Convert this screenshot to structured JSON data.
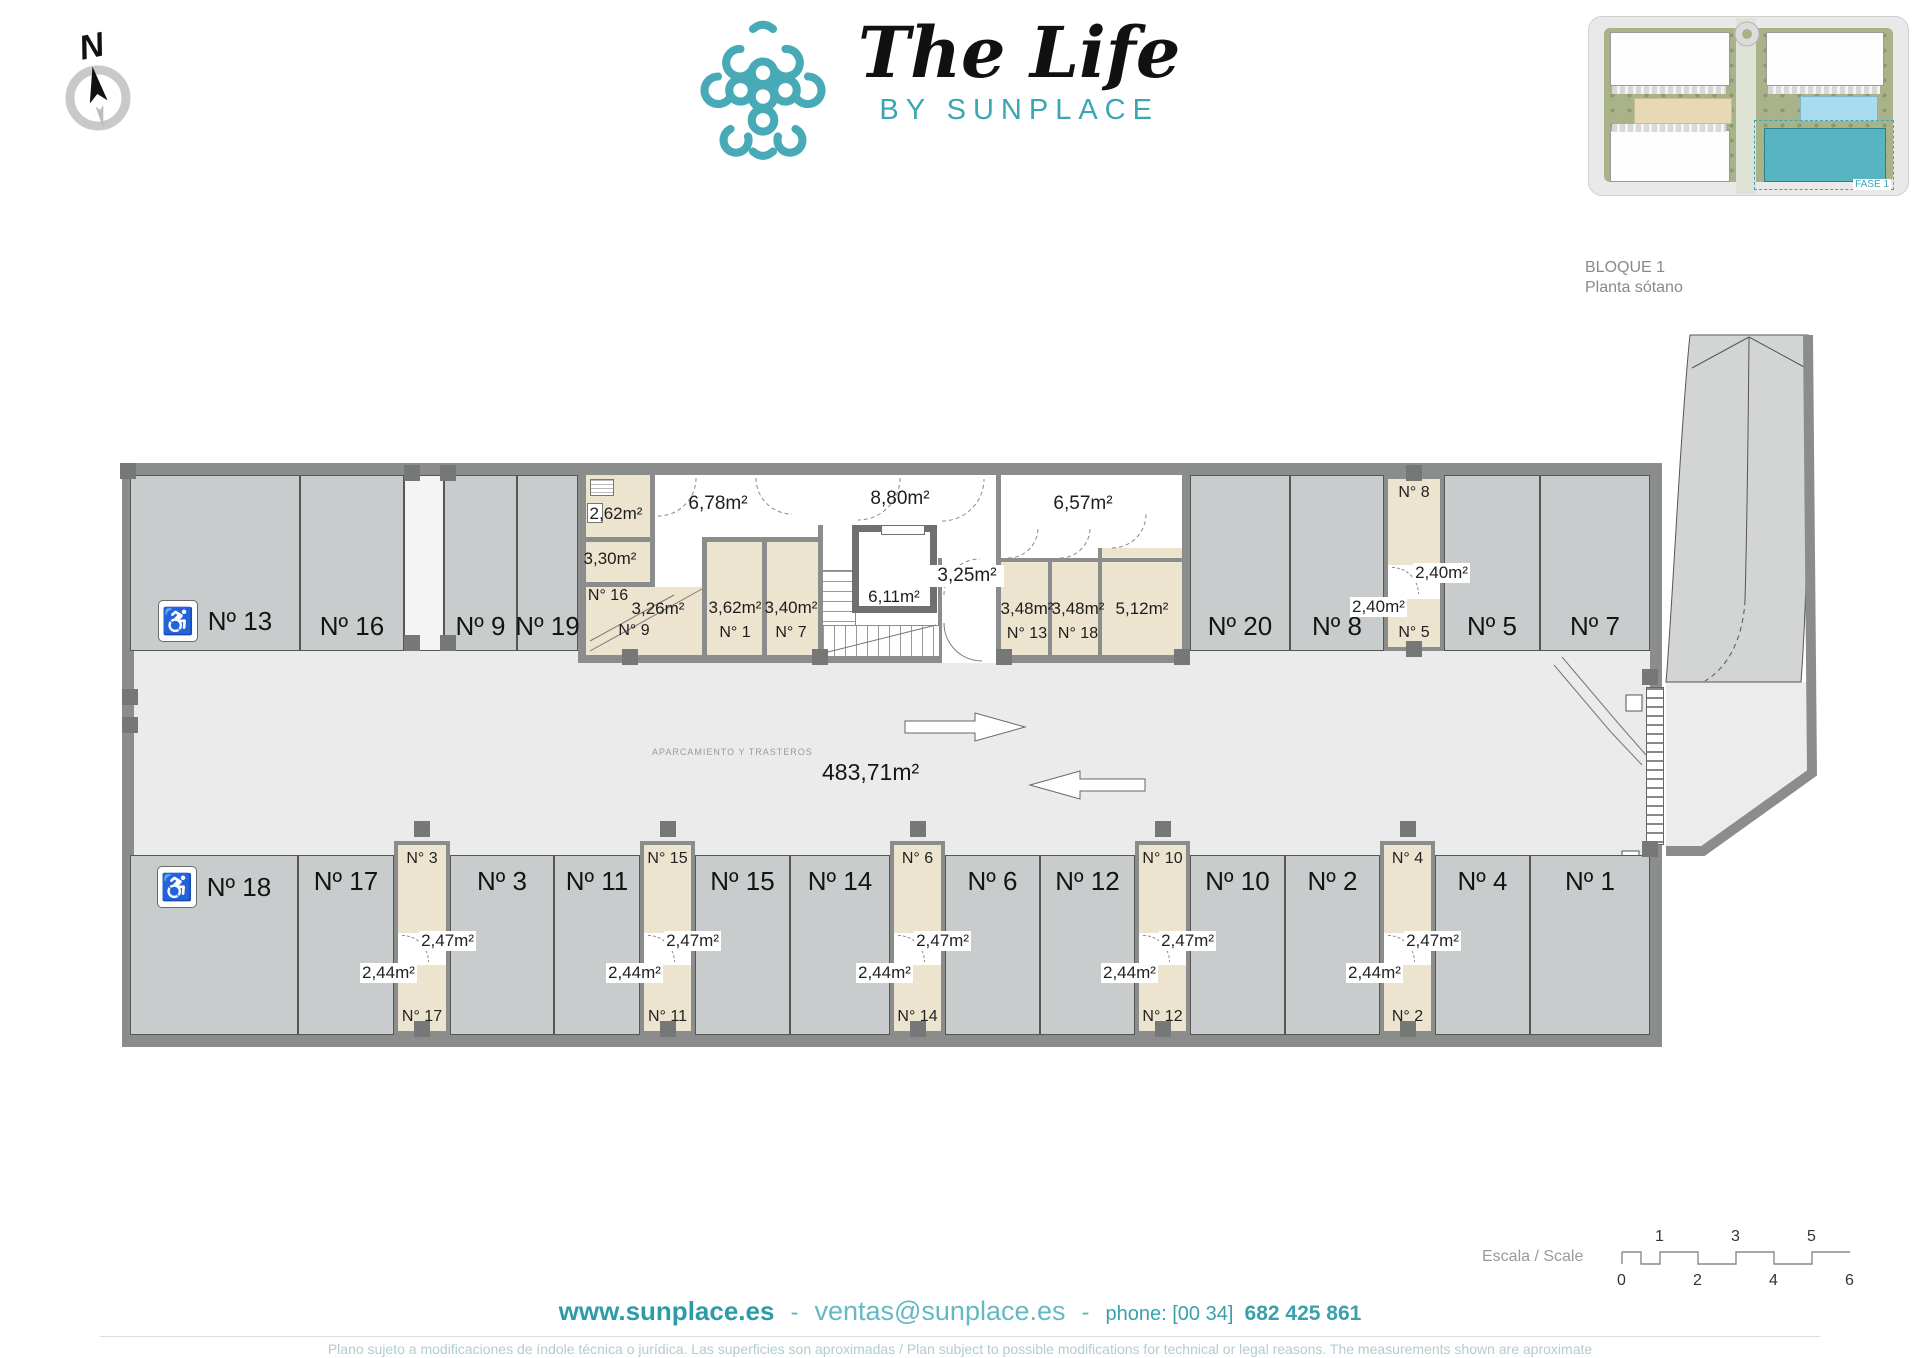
{
  "brand": {
    "title": "The Life",
    "subtitle": "BY SUNPLACE",
    "teal": "#3aa7b3"
  },
  "compass": {
    "label": "N"
  },
  "site_thumbnail": {
    "phase_label": "FASE 1"
  },
  "block_info": {
    "line1": "BLOQUE 1",
    "line2": "Planta sótano"
  },
  "plan": {
    "aisle_caption": "APARCAMIENTO Y TRASTEROS",
    "total_area": "483,71m²",
    "top_row": [
      {
        "label": "Nº 13",
        "x": 8,
        "w": 170,
        "accessible": true
      },
      {
        "label": "Nº 16",
        "x": 178,
        "w": 104
      },
      {
        "label": "Nº 9",
        "x": 322,
        "w": 73
      },
      {
        "label": "Nº 19",
        "x": 395,
        "w": 61
      },
      {
        "label": "Nº 20",
        "x": 1068,
        "w": 100
      },
      {
        "label": "Nº 8",
        "x": 1168,
        "w": 94
      },
      {
        "label": "Nº 5",
        "x": 1322,
        "w": 96
      },
      {
        "label": "Nº 7",
        "x": 1418,
        "w": 110
      }
    ],
    "bottom_row": [
      {
        "label": "Nº 18",
        "x": 8,
        "w": 168,
        "accessible": true
      },
      {
        "label": "Nº 17",
        "x": 176,
        "w": 96
      },
      {
        "label": "Nº 3",
        "x": 328,
        "w": 104
      },
      {
        "label": "Nº 11",
        "x": 432,
        "w": 86
      },
      {
        "label": "Nº 15",
        "x": 573,
        "w": 95
      },
      {
        "label": "Nº 14",
        "x": 668,
        "w": 100
      },
      {
        "label": "Nº 6",
        "x": 823,
        "w": 95
      },
      {
        "label": "Nº 12",
        "x": 918,
        "w": 95
      },
      {
        "label": "Nº 10",
        "x": 1068,
        "w": 95
      },
      {
        "label": "Nº 2",
        "x": 1163,
        "w": 95
      },
      {
        "label": "Nº 4",
        "x": 1313,
        "w": 95
      },
      {
        "label": "Nº 1",
        "x": 1408,
        "w": 120
      }
    ],
    "bottom_storage": [
      {
        "x": 272,
        "w": 56,
        "top_name": "N° 3",
        "top_area": "2,47m²",
        "bottom_area": "2,44m²",
        "bottom_name": "N° 17"
      },
      {
        "x": 518,
        "w": 55,
        "top_name": "N° 15",
        "top_area": "2,47m²",
        "bottom_area": "2,44m²",
        "bottom_name": "N° 11"
      },
      {
        "x": 768,
        "w": 55,
        "top_name": "N° 6",
        "top_area": "2,47m²",
        "bottom_area": "2,44m²",
        "bottom_name": "N° 14"
      },
      {
        "x": 1013,
        "w": 55,
        "top_name": "N° 10",
        "top_area": "2,47m²",
        "bottom_area": "2,44m²",
        "bottom_name": "N° 12"
      },
      {
        "x": 1258,
        "w": 55,
        "top_name": "N° 4",
        "top_area": "2,47m²",
        "bottom_area": "2,44m²",
        "bottom_name": "N° 2"
      }
    ],
    "top_storage": {
      "x": 1262,
      "w": 60,
      "top_name": "N° 8",
      "top_area": "2,40m²",
      "bottom_area": "2,40m²",
      "bottom_name": "N° 5"
    },
    "core": {
      "utility_top_area": "2,62m²",
      "utility_mid_area": "3,30m²",
      "room16": {
        "name": "N° 16",
        "area": "3,26m²",
        "sub": "N° 9"
      },
      "corridor_left": "6,78m²",
      "corridor_mid": "8,80m²",
      "corridor_right": "6,57m²",
      "room1": {
        "area": "3,62m²",
        "name": "N° 1"
      },
      "room7": {
        "area": "3,40m²",
        "name": "N° 7"
      },
      "elevator": "6,11m²",
      "landing": "3,25m²",
      "room13": {
        "area": "3,48m²",
        "name": "N° 13"
      },
      "room18": {
        "area": "3,48m²",
        "name": "N° 18"
      },
      "room512": "5,12m²"
    },
    "pillars": [
      {
        "x": -2,
        "y": 0
      },
      {
        "x": 282,
        "y": 2
      },
      {
        "x": 318,
        "y": 2
      },
      {
        "x": 282,
        "y": 172
      },
      {
        "x": 318,
        "y": 172
      },
      {
        "x": 500,
        "y": 186
      },
      {
        "x": 690,
        "y": 186
      },
      {
        "x": 874,
        "y": 186
      },
      {
        "x": 1052,
        "y": 186
      },
      {
        "x": 1284,
        "y": 2
      },
      {
        "x": 1284,
        "y": 178
      },
      {
        "x": 292,
        "y": 358
      },
      {
        "x": 538,
        "y": 358
      },
      {
        "x": 788,
        "y": 358
      },
      {
        "x": 1033,
        "y": 358
      },
      {
        "x": 1278,
        "y": 358
      },
      {
        "x": 292,
        "y": 558
      },
      {
        "x": 538,
        "y": 558
      },
      {
        "x": 788,
        "y": 558
      },
      {
        "x": 1033,
        "y": 558
      },
      {
        "x": 1278,
        "y": 558
      },
      {
        "x": 0,
        "y": 226
      },
      {
        "x": 0,
        "y": 254
      },
      {
        "x": 1520,
        "y": 206
      },
      {
        "x": 1520,
        "y": 378
      }
    ]
  },
  "scale_bar": {
    "label": "Escala / Scale",
    "top_numbers": [
      "1",
      "3",
      "5"
    ],
    "bottom_numbers": [
      "0",
      "2",
      "4",
      "6"
    ]
  },
  "footer": {
    "website": "www.sunplace.es",
    "sep1": "-",
    "email": "ventas@sunplace.es",
    "sep2": "-",
    "phone_label": "phone: [00 34]",
    "phone_number": "682 425 861",
    "disclaimer": "Plano sujeto a modificaciones de índole técnica o jurídica. Las superficies son aproximadas / Plan subject to possible modifications for technical or legal reasons. The measurements  shown are aproximate"
  }
}
